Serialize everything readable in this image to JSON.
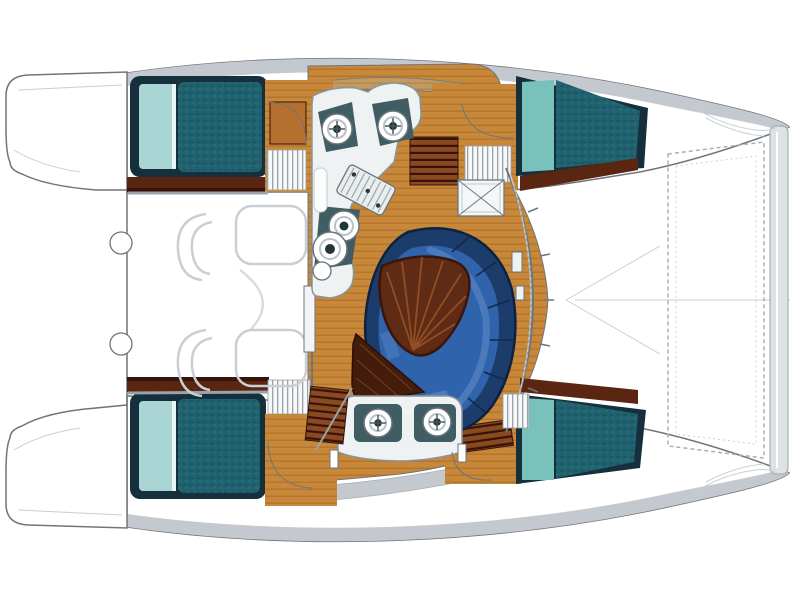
{
  "meta": {
    "aria_label": "Top-down interior layout plan of a sailing catamaran with two hulls, central saloon, galley, dinette and forward trampoline",
    "view": "plan-top-down",
    "vessel_type": "catamaran"
  },
  "palette": {
    "outline": "#6e757b",
    "faint": "#c9cfd4",
    "band": "#c3c9ce",
    "bandDark": "#a9b0b6",
    "hullWhite": "#ffffff",
    "deckTan": "#c39a60",
    "deckTanDark": "#9d7a45",
    "woodTrim": "#5a2511",
    "woodTrimDark": "#36120a",
    "woodTrimLight": "#8a4a20",
    "floor": "#c8883a",
    "floorStripe": "#a96c24",
    "doorWood": "#b5702f",
    "mattress": "#20626f",
    "mattressDark": "#184a56",
    "mattressFrame": "#152f3d",
    "pillow": "#a9d6d4",
    "glassPillow": "#79c2bc",
    "settee": "#1c3c6b",
    "setteeEdge": "#0e2240",
    "cushion": "#2f63ab",
    "cushionHi": "#5b86c5",
    "seam": "#14294a",
    "table": "#5f2b15",
    "tableDark": "#431c0c",
    "tableVein": "#9a552a",
    "counter": "#eff2f3",
    "counterShade": "#c6cfd3",
    "fixture": "#3f5d63",
    "fixtureDark": "#22353a",
    "steel": "#9aa3a9",
    "combLine": "#99a2a8",
    "trampLine": "#a9b1b8",
    "beamFill": "#dde2e5"
  },
  "components": [
    {
      "name": "port-hull",
      "contains": [
        "aft-double-berth",
        "companionway",
        "forward-berth"
      ]
    },
    {
      "name": "starboard-hull",
      "contains": [
        "aft-double-berth",
        "companionway",
        "forward-berth"
      ]
    },
    {
      "name": "saloon",
      "contains": [
        "galley-unit",
        "dinette-settee",
        "cocktail-table",
        "deck-hatch"
      ]
    },
    {
      "name": "aft-cockpit",
      "contains": [
        "bench-seats",
        "transom-steps"
      ]
    },
    {
      "name": "foredeck",
      "contains": [
        "trampoline",
        "forward-crossbeam"
      ]
    }
  ]
}
